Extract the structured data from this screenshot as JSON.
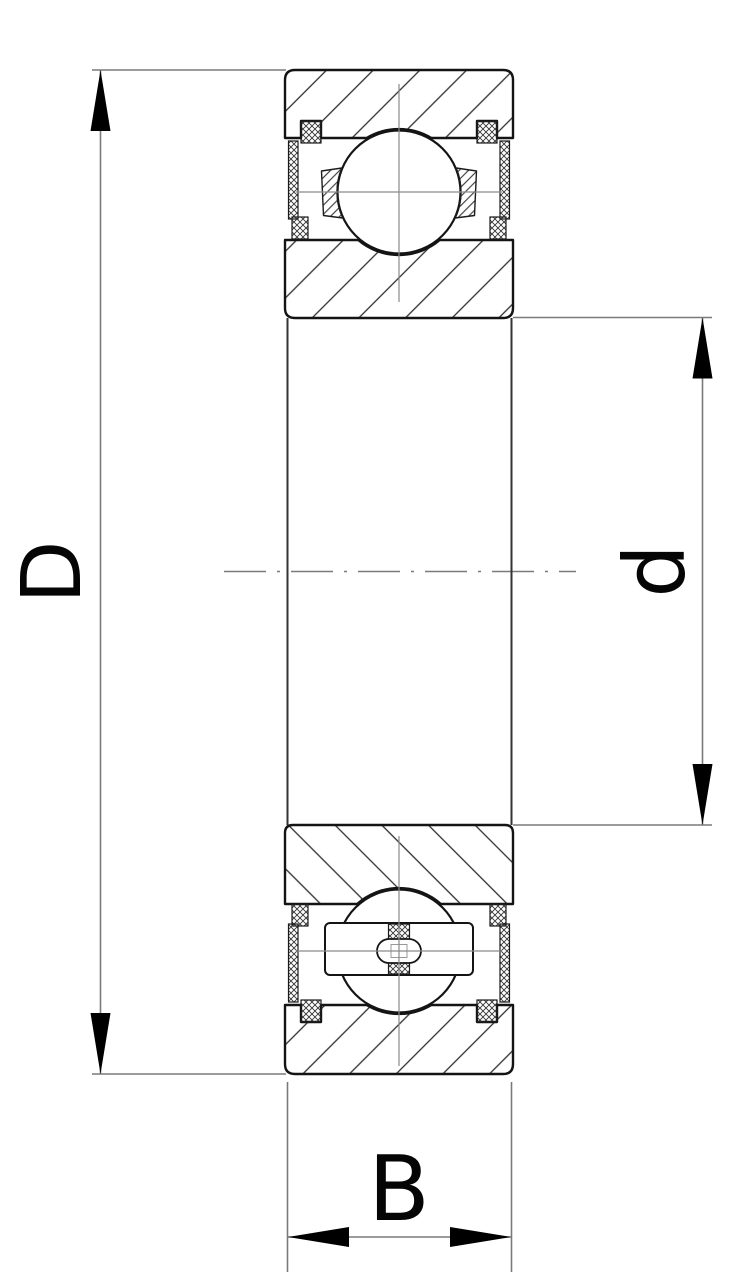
{
  "figure": {
    "type": "ball-bearing-cross-section-drawing"
  },
  "dimensions": {
    "outer_diameter": "D",
    "bore_diameter": "d",
    "width": "B"
  },
  "colors": {
    "background": "#ffffff",
    "outline": "#141414",
    "hatch": "#2e2e2e",
    "dimension_lines": "#7a7a7a",
    "arrowheads": "#000000",
    "labels": "#050505"
  }
}
